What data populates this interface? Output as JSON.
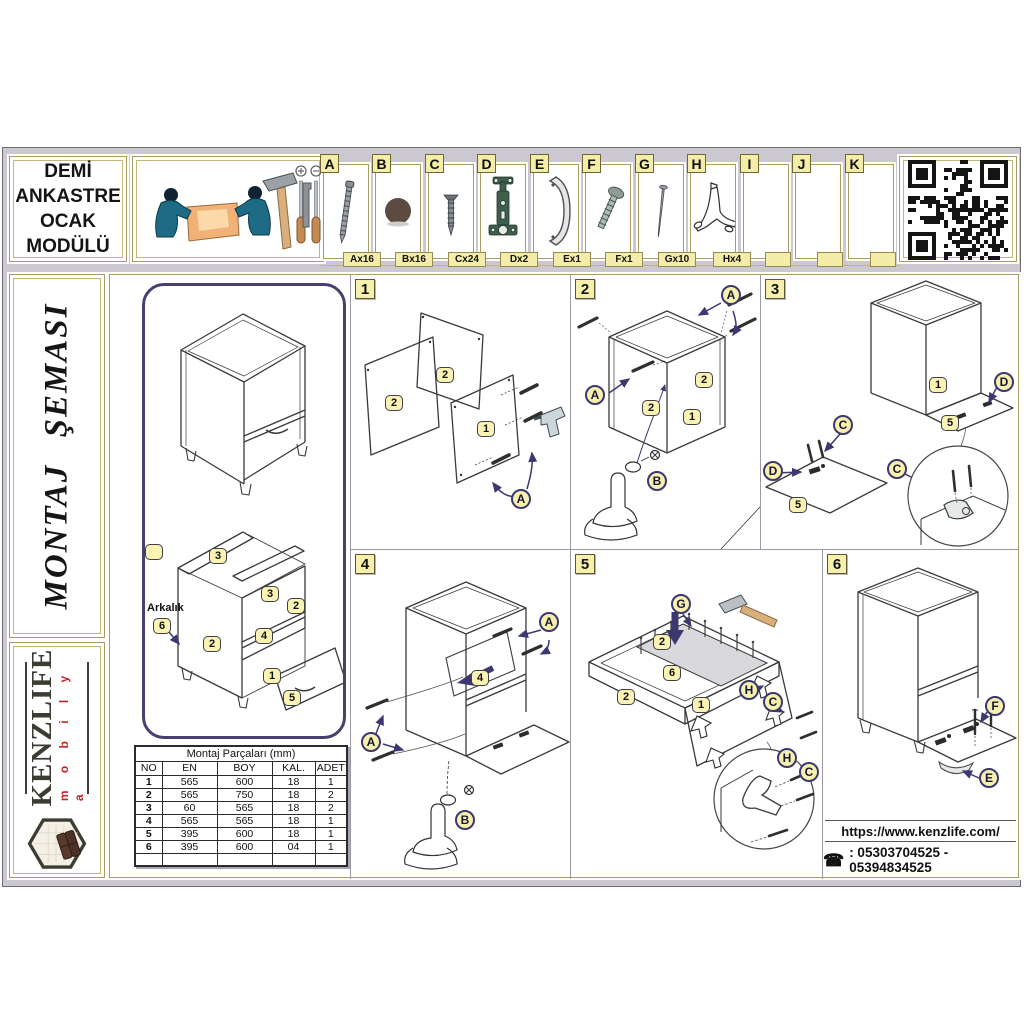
{
  "title": {
    "lines": [
      "DEMİ",
      "ANKASTRE",
      "OCAK",
      "MODÜLÜ"
    ]
  },
  "hardware": {
    "items": [
      {
        "letter": "A",
        "qty": "Ax16",
        "icon": "confirmat-screw-icon"
      },
      {
        "letter": "B",
        "qty": "Bx16",
        "icon": "cover-cap-icon"
      },
      {
        "letter": "C",
        "qty": "Cx24",
        "icon": "chipboard-screw-icon"
      },
      {
        "letter": "D",
        "qty": "Dx2",
        "icon": "hinge-icon"
      },
      {
        "letter": "E",
        "qty": "Ex1",
        "icon": "handle-icon"
      },
      {
        "letter": "F",
        "qty": "Fx1",
        "icon": "handle-bolt-icon"
      },
      {
        "letter": "G",
        "qty": "Gx10",
        "icon": "nail-icon"
      },
      {
        "letter": "H",
        "qty": "Hx4",
        "icon": "plastic-leg-icon"
      },
      {
        "letter": "I",
        "qty": "",
        "icon": ""
      },
      {
        "letter": "J",
        "qty": "",
        "icon": ""
      },
      {
        "letter": "K",
        "qty": "",
        "icon": ""
      }
    ]
  },
  "left_panel": {
    "schema_title": "MONTAJ ŞEMASI",
    "brand": "KENZLIFE",
    "brand_sub": "m o b i l y a"
  },
  "overview": {
    "back_panel_label": "Arkalık",
    "badges": {
      "rail_a": "3",
      "rail_b": "3",
      "side_right": "2",
      "side_left": "2",
      "shelf": "4",
      "bottom": "1",
      "drawer": "5",
      "back": "6"
    }
  },
  "parts_table": {
    "title": "Montaj Parçaları (mm)",
    "headers": [
      "NO",
      "EN",
      "BOY",
      "KAL.",
      "ADET"
    ],
    "rows": [
      [
        "1",
        "565",
        "600",
        "18",
        "1"
      ],
      [
        "2",
        "565",
        "750",
        "18",
        "2"
      ],
      [
        "3",
        "60",
        "565",
        "18",
        "2"
      ],
      [
        "4",
        "565",
        "565",
        "18",
        "1"
      ],
      [
        "5",
        "395",
        "600",
        "18",
        "1"
      ],
      [
        "6",
        "395",
        "600",
        "04",
        "1"
      ]
    ]
  },
  "steps": {
    "s1": {
      "num": "1",
      "b2a": "2",
      "b2b": "2",
      "b1": "1",
      "cA": "A"
    },
    "s2": {
      "num": "2",
      "cA1": "A",
      "cA2": "A",
      "b2a": "2",
      "b2b": "2",
      "b1": "1",
      "cB": "B"
    },
    "s3": {
      "num": "3",
      "b1": "1",
      "b5a": "5",
      "b5b": "5",
      "cD1": "D",
      "cD2": "D",
      "cC1": "C",
      "cC2": "C"
    },
    "s4": {
      "num": "4",
      "b4": "4",
      "cA1": "A",
      "cA2": "A",
      "cB": "B"
    },
    "s5": {
      "num": "5",
      "b2a": "2",
      "b6": "6",
      "b2b": "2",
      "b1": "1",
      "cG": "G",
      "cH1": "H",
      "cC1": "C",
      "cH2": "H",
      "cC2": "C"
    },
    "s6": {
      "num": "6",
      "cF": "F",
      "cE": "E"
    }
  },
  "footer": {
    "website": "https://www.kenzlife.com/",
    "phone": ": 05303704525 - 05394834525",
    "phone_icon": "☎"
  }
}
